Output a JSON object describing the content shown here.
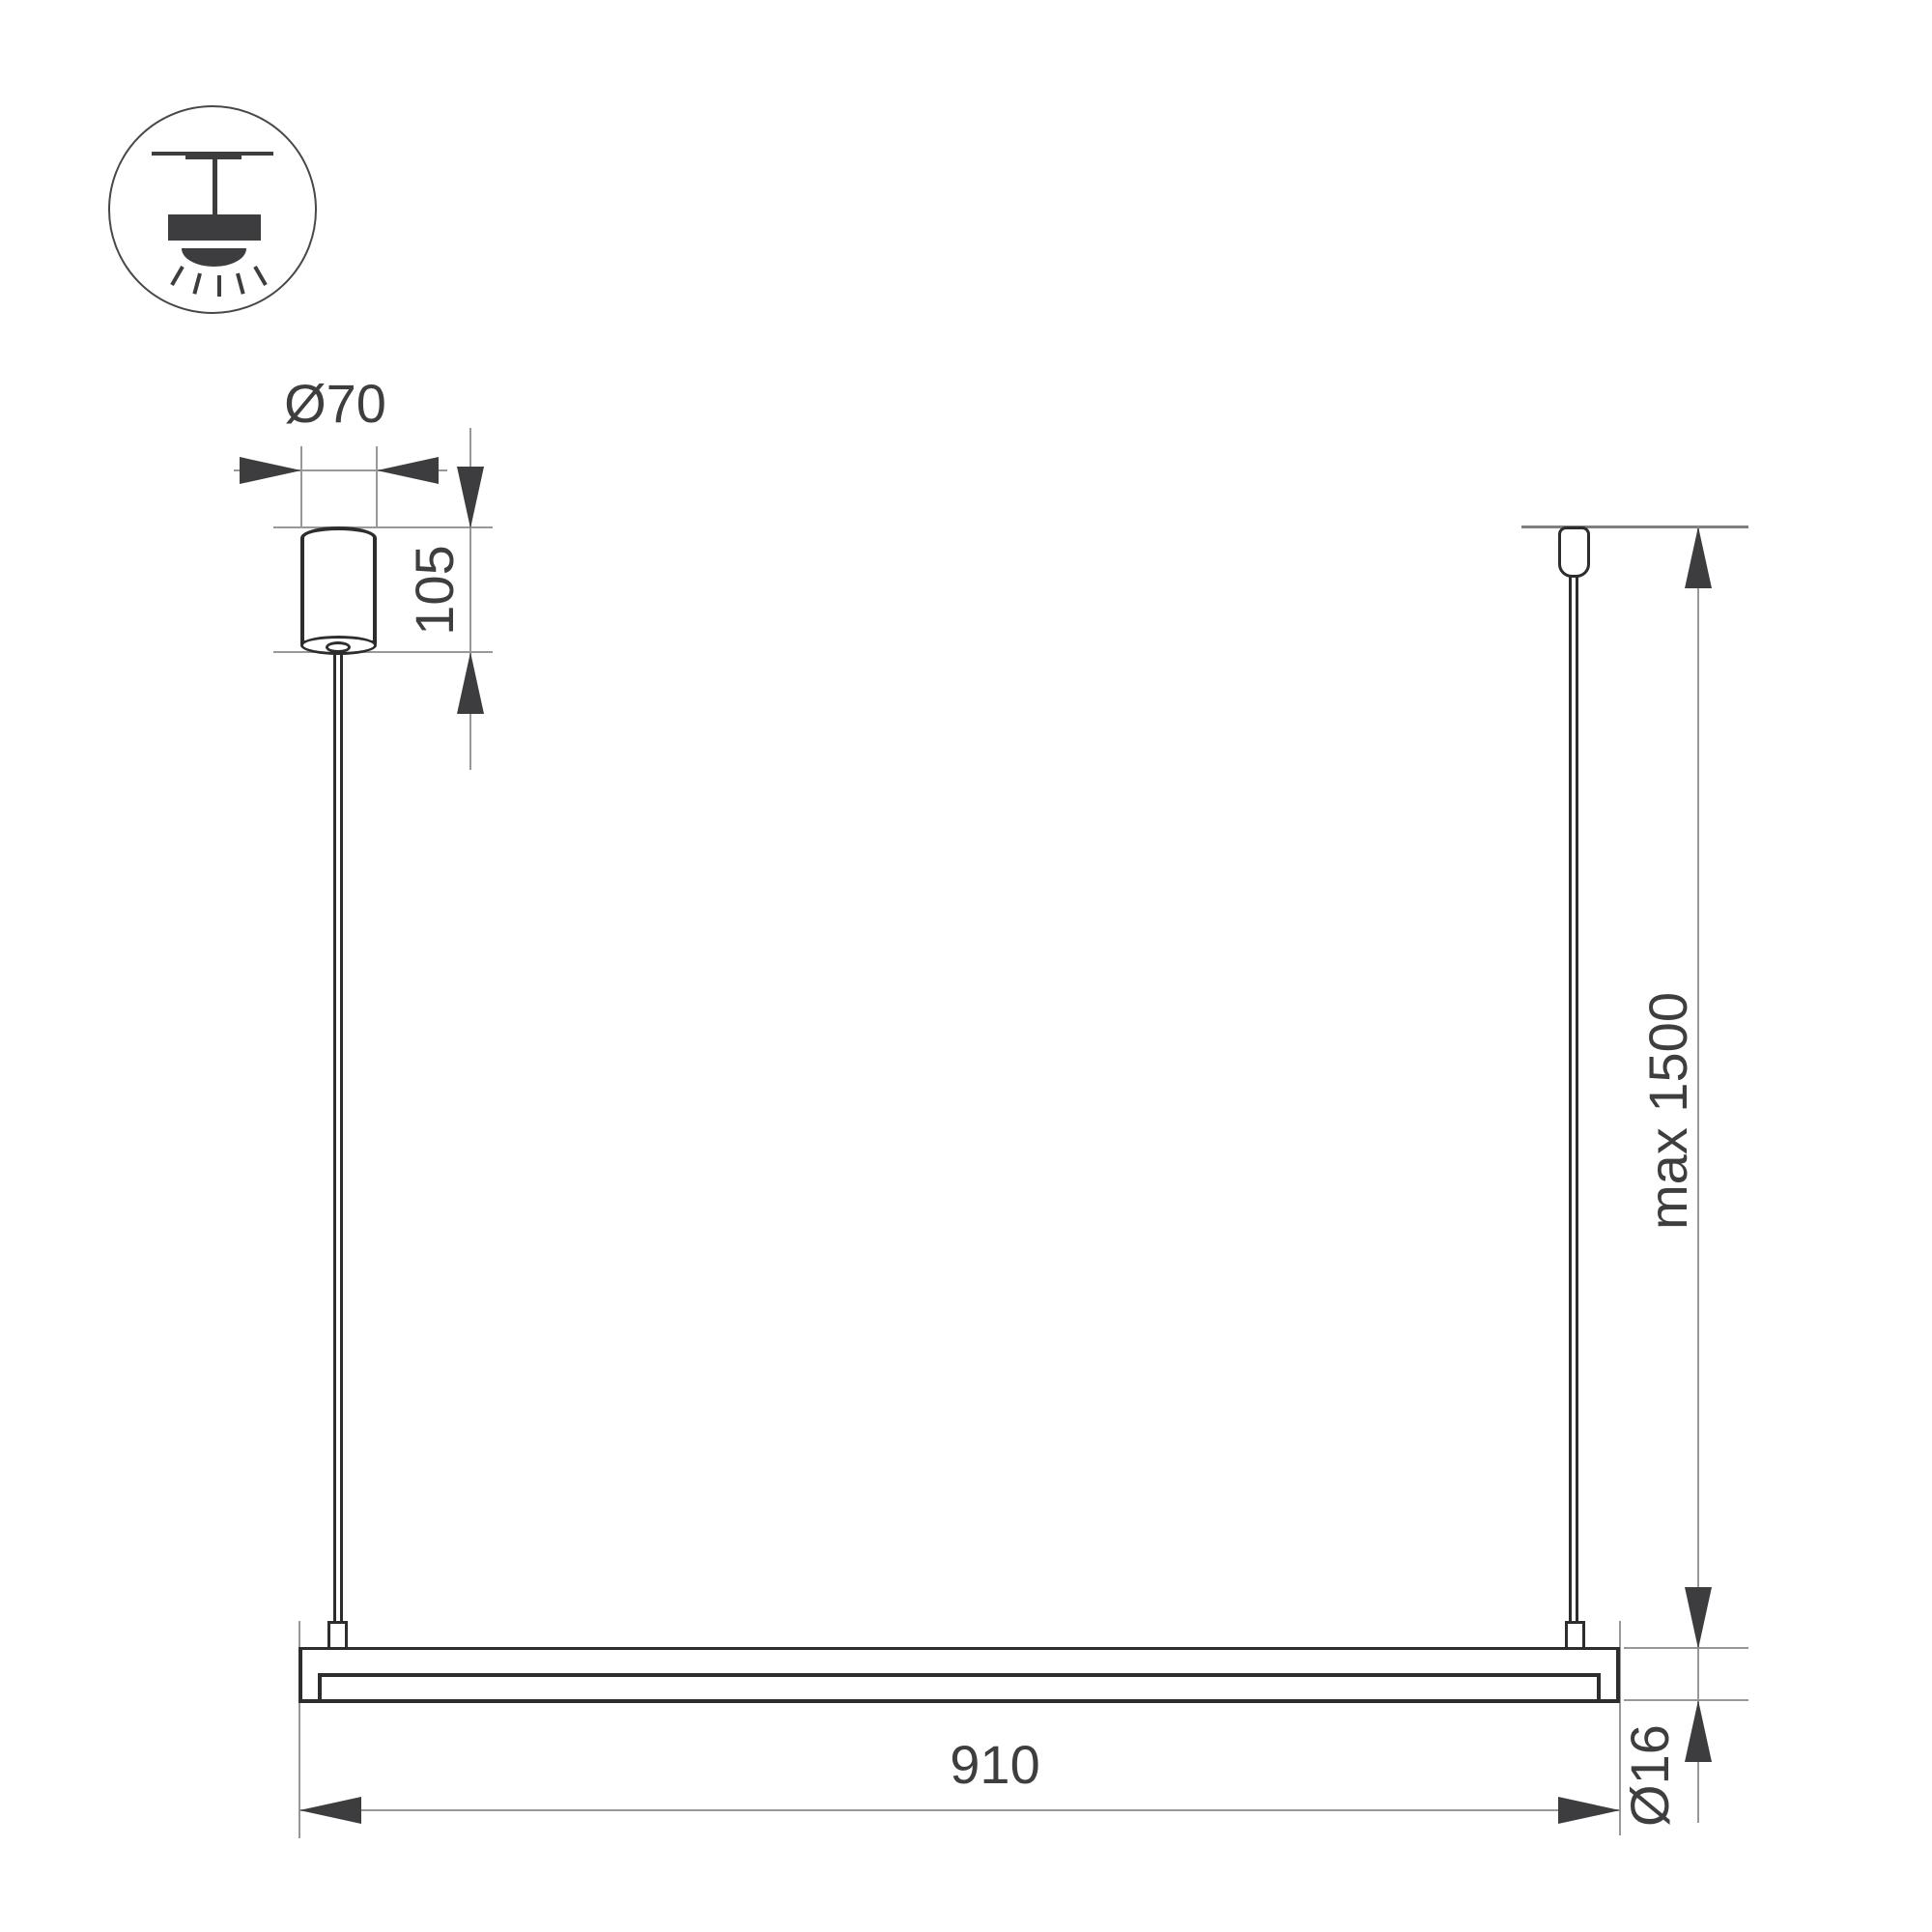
{
  "page": {
    "type": "technical-dimension-drawing",
    "subject": "linear-pendant-light-fixture",
    "background": "#ffffff"
  },
  "icon_legend": {
    "name": "ceiling-pendant-light"
  },
  "labels": {
    "canopy_diameter": "Ø70",
    "canopy_height": "105",
    "suspension_length": "max 1500",
    "bar_length": "910",
    "bar_diameter": "Ø16"
  },
  "colors": {
    "outline": "#2d2d2f",
    "arrow_fill": "#3d3d3f",
    "dimension_line": "#98989a",
    "text": "#3e3e40",
    "background": "#ffffff"
  }
}
